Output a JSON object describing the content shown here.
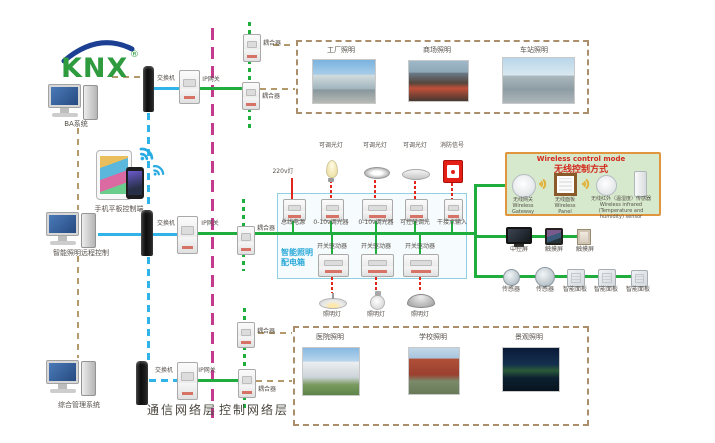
{
  "logo": {
    "text": "KNX",
    "reg": "®"
  },
  "left": {
    "ba": "BA系统",
    "mobile": "手机平板控制端",
    "remote": "智能照明远程控制",
    "mgmt": "综合管理系统"
  },
  "network": {
    "switch": "交换机",
    "gateway": "IP网关",
    "coupler": "耦合器",
    "comm_layer": "通信网络层",
    "ctrl_layer": "控制网络层"
  },
  "zones": {
    "top": [
      "工厂照明",
      "商场照明",
      "车站照明"
    ],
    "bottom": [
      "医院照明",
      "学校照明",
      "景观照明"
    ]
  },
  "panel": {
    "title1": "智能照明",
    "title2": "配电箱",
    "supply": "220v灯",
    "loads_top": [
      "可调光灯",
      "可调光灯",
      "可调光灯",
      "消防信号"
    ],
    "row1": [
      "总线电源",
      "0-10v调光器",
      "0-10v调光器",
      "可控硅调光",
      "干接点输入"
    ],
    "row2": [
      "开关驱动器",
      "开关驱动器",
      "开关驱动器"
    ],
    "loads_bottom": [
      "照明灯",
      "照明灯",
      "照明灯"
    ]
  },
  "wireless": {
    "title_en": "Wireless control mode",
    "title_zh": "无线控制方式",
    "gateway_zh": "无线网关",
    "gateway_en": "Wireless Gateway",
    "panel_zh": "无线面板",
    "panel_en": "Wireless Panel",
    "sensor_zh": "无线红外（温湿度）传感器",
    "sensor_en": "Wireless infrared (Temperature and humidity) sensor"
  },
  "right": {
    "row1": [
      "中控屏",
      "触摸屏",
      "触摸屏"
    ],
    "row2": [
      "传感器",
      "传感器",
      "智能面板",
      "智能面板",
      "智能面板"
    ]
  },
  "colors": {
    "bus_green": "#1fae3e",
    "comm_blue": "#2fb3e8",
    "layer_magenta": "#c43a8c",
    "backbone_tan": "#b49a6a",
    "load_red": "#e3261a",
    "panel_blue": "#29a8d8",
    "wireless_border": "#e0953f",
    "wireless_bg": "#d6e9cc",
    "alert_red": "#d42a1e"
  }
}
